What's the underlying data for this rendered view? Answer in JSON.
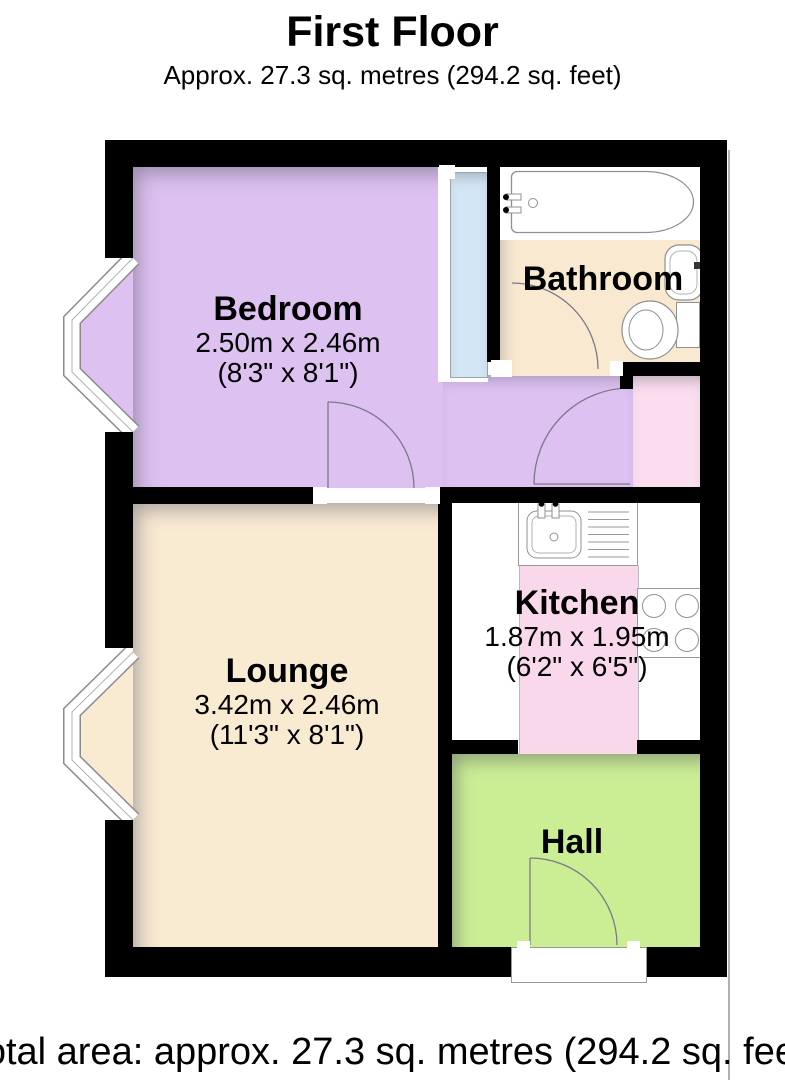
{
  "header": {
    "title": "First Floor",
    "subtitle": "Approx. 27.3 sq. metres (294.2 sq. feet)"
  },
  "rooms": [
    {
      "name": "Bedroom",
      "dim_metric": "2.50m x 2.46m",
      "dim_imperial": "(8'3\" x 8'1\")",
      "floor_color": "#ddc1f1"
    },
    {
      "name": "Bathroom",
      "dim_metric": "",
      "dim_imperial": "",
      "floor_color": "#f9e9d0"
    },
    {
      "name": "Kitchen",
      "dim_metric": "1.87m x 1.95m",
      "dim_imperial": "(6'2\" x 6'5\")",
      "floor_color": "#f8d8ea"
    },
    {
      "name": "Lounge",
      "dim_metric": "3.42m x 2.46m",
      "dim_imperial": "(11'3\" x 8'1\")",
      "floor_color": "#f9ead2"
    },
    {
      "name": "Hall",
      "dim_metric": "",
      "dim_imperial": "",
      "floor_color": "#cbee94"
    }
  ],
  "extras": {
    "corridor_color": "#ddc1f1",
    "pink_strip_color": "#fadeef",
    "glazing_color": "#d3e6f5",
    "wall_color": "#000000",
    "fixture_outline": "#909090"
  },
  "fixtures": [
    "bathtub",
    "washbasin",
    "toilet",
    "kitchen-sink",
    "drainer",
    "hob"
  ],
  "footer": {
    "caption": "Total area: approx. 27.3 sq. metres (294.2 sq. feet)"
  }
}
